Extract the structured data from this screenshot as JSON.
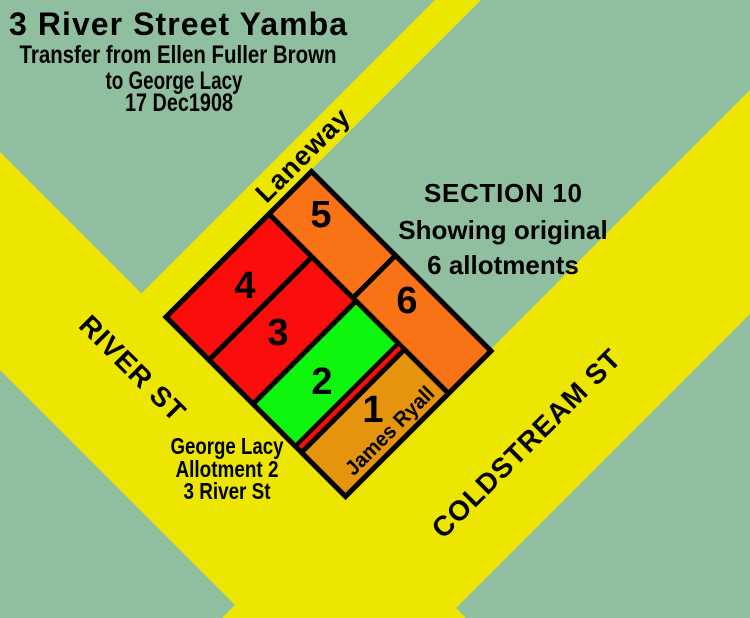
{
  "colors": {
    "background": "#8FBF9E",
    "street_yellow": "#EDE600",
    "outline_black": "#000000",
    "orange": "#F97316",
    "red": "#FA0D0A",
    "bright_green": "#0DF50D",
    "amber": "#E5940E"
  },
  "title_block": {
    "title": "3 River Street Yamba",
    "transfer_line1": "Transfer from Ellen Fuller Brown",
    "transfer_line2": "to George Lacy",
    "transfer_line3": "17 Dec1908"
  },
  "section_note": {
    "line1": "SECTION 10",
    "line2": "Showing original",
    "line3": "6 allotments"
  },
  "owner_note": {
    "line1": "George Lacy",
    "line2": "Allotment 2",
    "line3": "3 River St"
  },
  "streets": {
    "laneway": "Laneway",
    "river": "RIVER ST",
    "coldstream": "COLDSTREAM ST"
  },
  "allotments": [
    {
      "number": "1",
      "owner": "James Ryall",
      "color": "#E5940E"
    },
    {
      "number": "2",
      "color": "#0DF50D"
    },
    {
      "number": "3",
      "color": "#FA0D0A"
    },
    {
      "number": "4",
      "color": "#FA0D0A"
    },
    {
      "number": "5",
      "color": "#F97316"
    },
    {
      "number": "6",
      "color": "#F97316"
    }
  ],
  "strip": {
    "color": "#FA0D0A"
  }
}
